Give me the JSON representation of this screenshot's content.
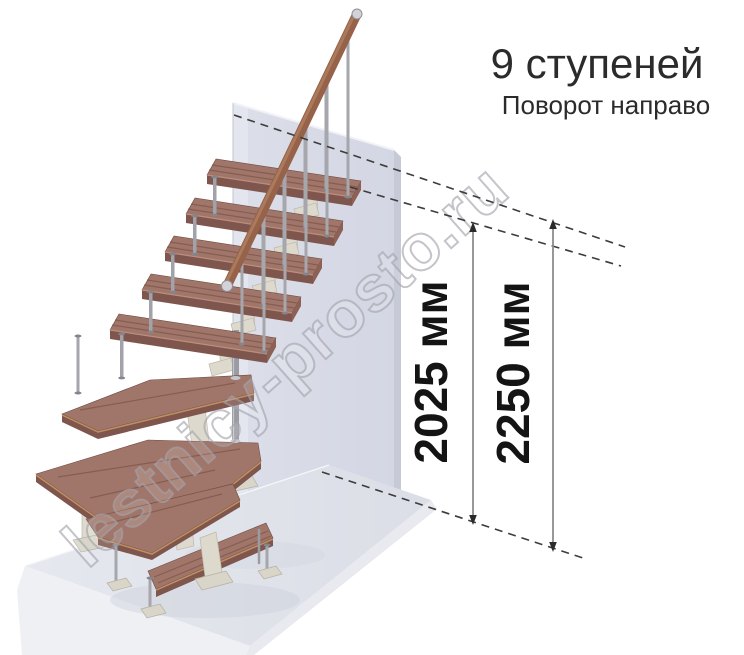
{
  "header": {
    "title": "9 ступеней",
    "subtitle": "Поворот направо"
  },
  "watermark": {
    "text": "lestnicy-prosto.ru"
  },
  "diagram": {
    "type": "staircase-isometric-view",
    "steps_count": 9,
    "turn_direction": "направо",
    "dimensions": [
      {
        "id": "top-step-level",
        "label": "2025 мм",
        "value_mm": 2025
      },
      {
        "id": "upper-floor-level",
        "label": "2250 мм",
        "value_mm": 2250
      }
    ],
    "colors": {
      "tread_wood": "#a1766a",
      "tread_edge": "#7f564d",
      "handrail_wood": "#966249",
      "metal_parts": "#a6a6ad",
      "support_frame": "#ddd9cc",
      "wall": "#d7dae6",
      "floor_slab": "#e2e4eb",
      "dashed_level_line": "#3c3c3c",
      "dimension_text": "#141414"
    }
  }
}
